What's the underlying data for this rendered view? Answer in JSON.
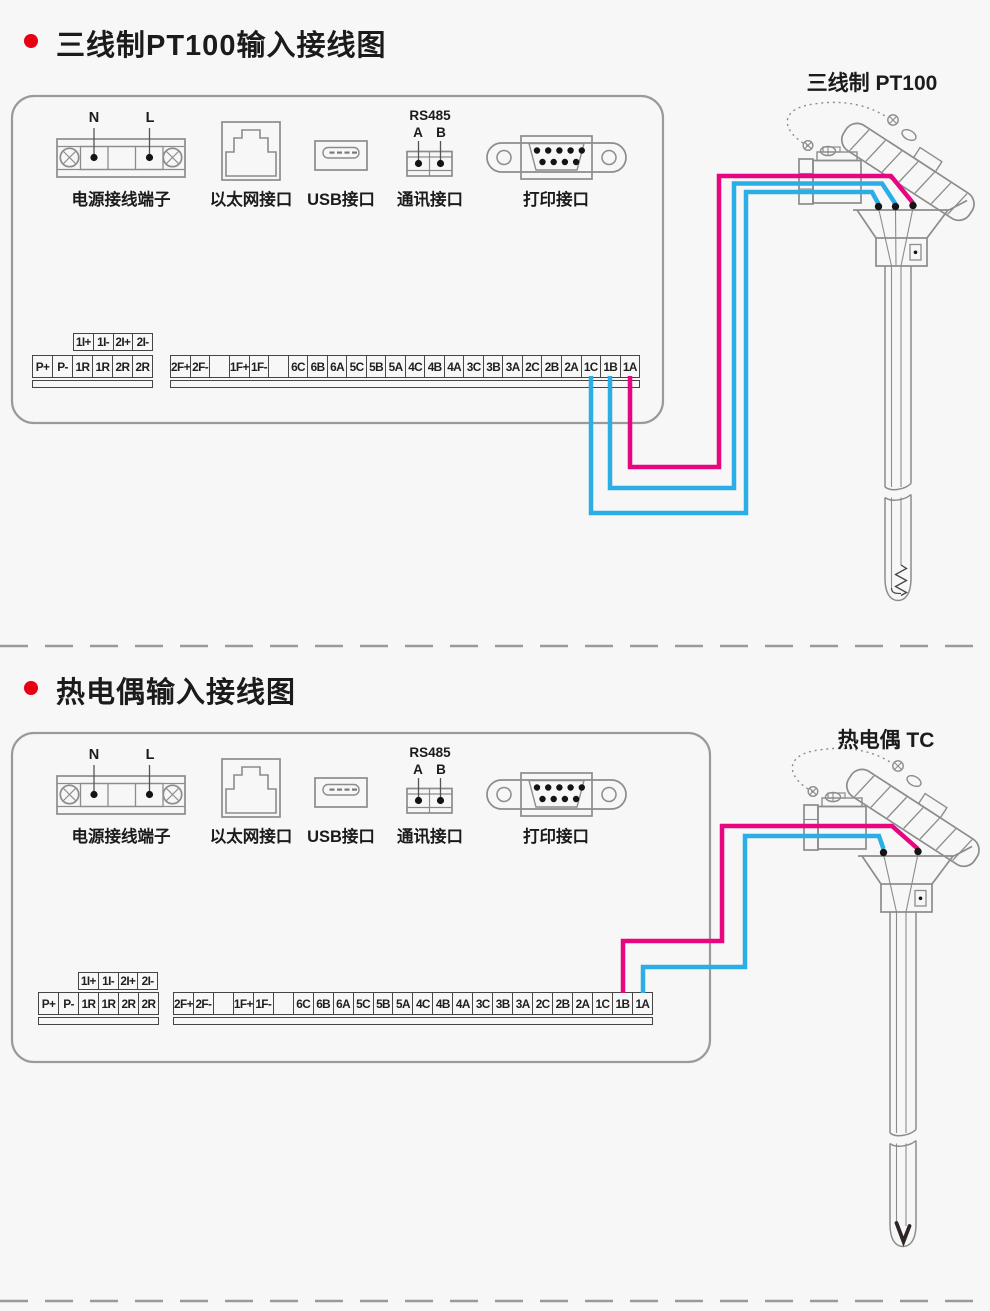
{
  "colors": {
    "bullet_red": "#e60012",
    "wire_magenta": "#e7067f",
    "wire_cyan": "#2baee6",
    "diagram_gray": "#8c8c8c",
    "panel_gray": "#9a9a9a",
    "terminal_dark": "#454545",
    "text": "#1b1b1b"
  },
  "sections": [
    {
      "title": "三线制PT100输入接线图",
      "probe_label": "三线制 PT100",
      "probe_type": "RTD",
      "connections": [
        {
          "terminal": "1C",
          "wire_color": "cyan"
        },
        {
          "terminal": "1B",
          "wire_color": "cyan"
        },
        {
          "terminal": "1A",
          "wire_color": "magenta"
        }
      ]
    },
    {
      "title": "热电偶输入接线图",
      "probe_label": "热电偶 TC",
      "probe_type": "TC",
      "connections": [
        {
          "terminal": "1B",
          "wire_color": "magenta"
        },
        {
          "terminal": "1A",
          "wire_color": "cyan"
        }
      ]
    }
  ],
  "ports": {
    "power": {
      "label": "电源接线端子",
      "pin_labels": [
        "N",
        "L"
      ]
    },
    "ethernet": {
      "label": "以太网接口"
    },
    "usb": {
      "label": "USB接口"
    },
    "comm": {
      "label": "通讯接口",
      "bus": "RS485",
      "pin_labels": [
        "A",
        "B"
      ]
    },
    "printer": {
      "label": "打印接口"
    }
  },
  "terminals": {
    "aux_row": [
      "1I+",
      "1I-",
      "2I+",
      "2I-"
    ],
    "left_row": [
      "P+",
      "P-",
      "1R",
      "1R",
      "2R",
      "2R"
    ],
    "right_row": [
      "2F+",
      "2F-",
      "",
      "1F+",
      "1F-",
      "",
      "6C",
      "6B",
      "6A",
      "5C",
      "5B",
      "5A",
      "4C",
      "4B",
      "4A",
      "3C",
      "3B",
      "3A",
      "2C",
      "2B",
      "2A",
      "1C",
      "1B",
      "1A"
    ]
  }
}
